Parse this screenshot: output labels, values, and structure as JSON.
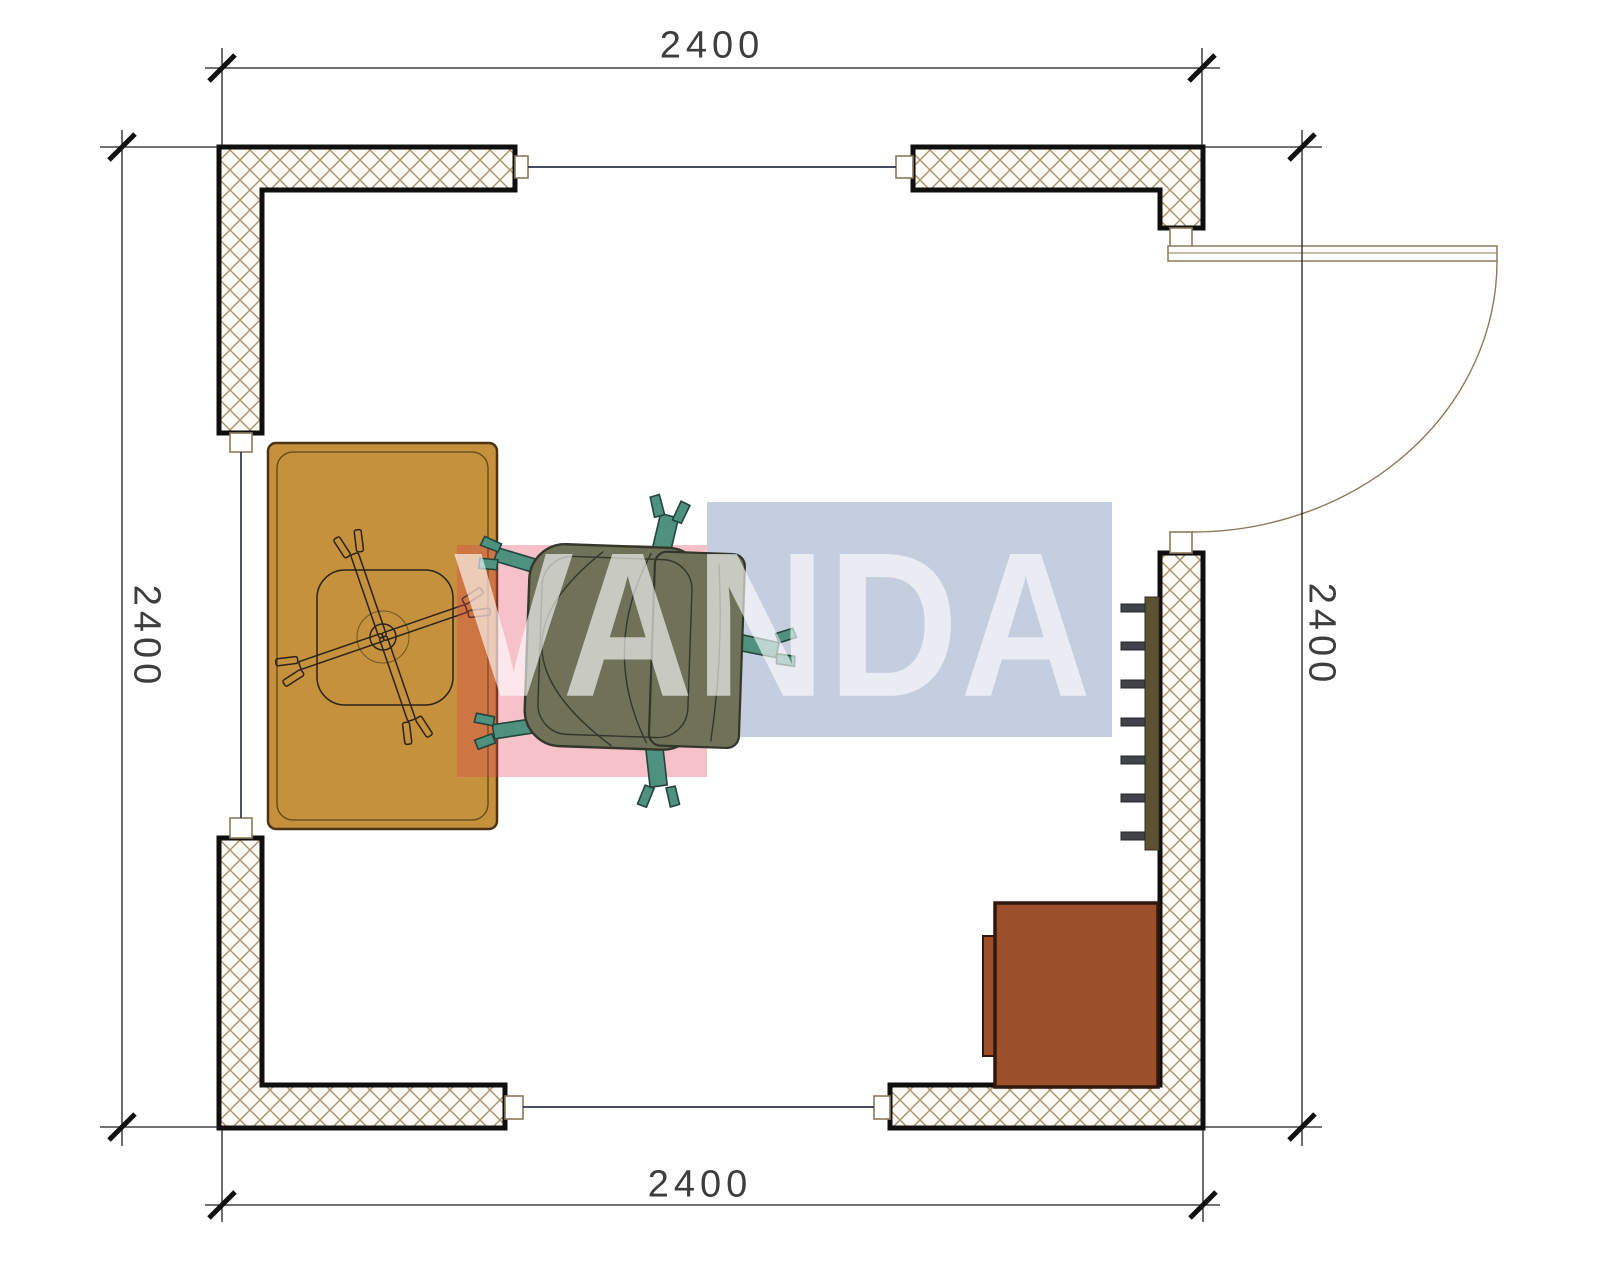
{
  "title": "Floor plan 2400 x 2400 with office furniture",
  "dimensions": {
    "top": {
      "label": "2400"
    },
    "bottom": {
      "label": "2400"
    },
    "left": {
      "label": "2400"
    },
    "right": {
      "label": "2400"
    }
  },
  "watermark": {
    "text": "VANDA",
    "red_block_color": "#E23E55",
    "blue_block_color": "#406296",
    "text_color": "#FFFFFF"
  },
  "plan": {
    "wall_hatch_line_color": "#A79468",
    "wall_outline_color": "#0F0F0F",
    "window_line_color": "#2B3550",
    "desk_color": "#C5913C",
    "chair_seat_color": "#6F7259",
    "chair_leg_color": "#4F917F",
    "cabinet_color": "#9C4F2B",
    "radiator_color": "#5C5233",
    "radiator_tab_color": "#3F4246",
    "furniture": [
      "desk",
      "office-chair",
      "chair-base",
      "radiator",
      "cabinet"
    ],
    "openings": [
      "window-top",
      "window-left",
      "window-bottom",
      "door-right-top"
    ]
  }
}
